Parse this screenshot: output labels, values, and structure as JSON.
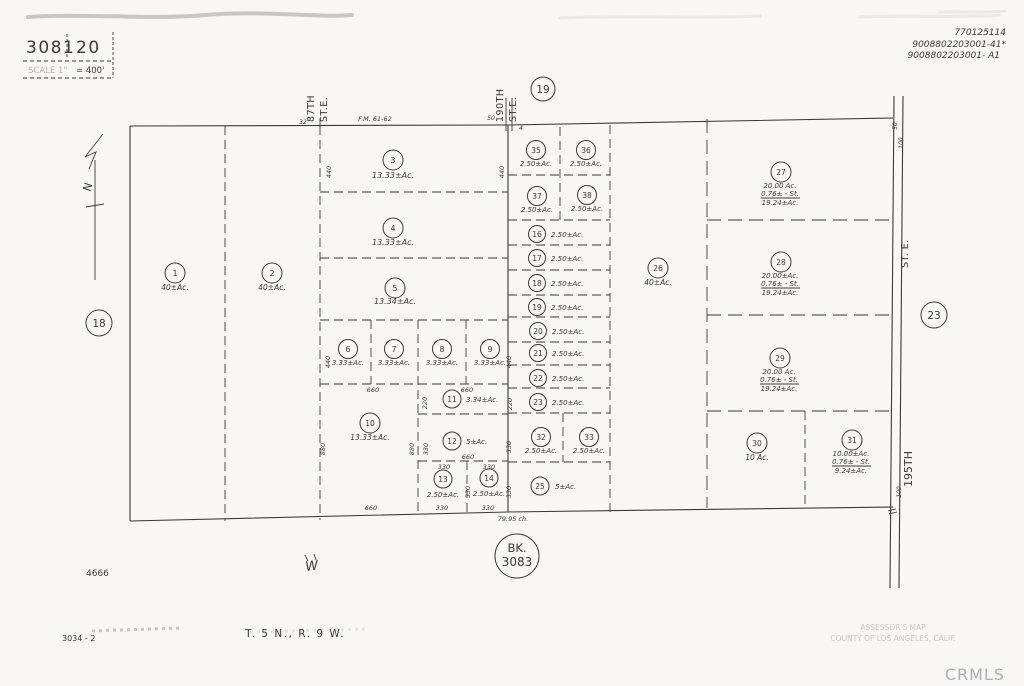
{
  "header": {
    "book": "3081",
    "page": "20",
    "scale_label": "SCALE 1\"",
    "scale_value": "= 400'",
    "handwriting1": "770125114",
    "handwriting2": "9008802203001-41*",
    "handwriting3": "9008802203001- A1"
  },
  "streets": {
    "s87_name": "87TH",
    "s87_suffix": "ST.E.",
    "s190_name": "190TH",
    "s190_suffix": "ST.E.",
    "s195_suffix": "ST. E.",
    "s195_name": "195TH"
  },
  "compass": {
    "north": "N"
  },
  "adjacent_pages": {
    "west": "18",
    "north": "19",
    "east": "23"
  },
  "bk_circle": {
    "prefix": "BK.",
    "number": "3083"
  },
  "survey": {
    "fm_ref": "F.M. 61-62",
    "tick_32": "32",
    "tick_50": "50",
    "tick_4": "4",
    "chains": "79.95 ch.",
    "d440": "440",
    "d660": "660",
    "d330": "330",
    "d880": "880",
    "d220": "220",
    "d100": "100",
    "d50": "50"
  },
  "parcels": {
    "1": {
      "num": "1",
      "area": "40±Ac."
    },
    "2": {
      "num": "2",
      "area": "40±Ac."
    },
    "3": {
      "num": "3",
      "area": "13.33±Ac."
    },
    "4": {
      "num": "4",
      "area": "13.33±Ac."
    },
    "5": {
      "num": "5",
      "area": "13.34±Ac."
    },
    "6": {
      "num": "6",
      "area": "3.33±Ac."
    },
    "7": {
      "num": "7",
      "area": "3.33±Ac."
    },
    "8": {
      "num": "8",
      "area": "3.33±Ac."
    },
    "9": {
      "num": "9",
      "area": "3.33±Ac."
    },
    "10": {
      "num": "10",
      "area": "13.33±Ac."
    },
    "11": {
      "num": "11",
      "area": "3.34±Ac."
    },
    "12": {
      "num": "12",
      "area": "5±Ac."
    },
    "13": {
      "num": "13",
      "area": "2.50±Ac."
    },
    "14": {
      "num": "14",
      "area": "2.50±Ac."
    },
    "16": {
      "num": "16",
      "area": "2.50±Ac."
    },
    "17": {
      "num": "17",
      "area": "2.50±Ac."
    },
    "18": {
      "num": "18",
      "area": "2.50±Ac."
    },
    "19": {
      "num": "19",
      "area": "2.50±Ac."
    },
    "20": {
      "num": "20",
      "area": "2.50±Ac."
    },
    "21": {
      "num": "21",
      "area": "2.50±Ac."
    },
    "22": {
      "num": "22",
      "area": "2.50±Ac."
    },
    "23": {
      "num": "23",
      "area": "2.50±Ac."
    },
    "25": {
      "num": "25",
      "area": "5±Ac."
    },
    "26": {
      "num": "26",
      "area": "40±Ac."
    },
    "27": {
      "num": "27",
      "gross": "20.00 Ac.",
      "street": "0.76± - St.",
      "net": "19.24±Ac."
    },
    "28": {
      "num": "28",
      "gross": "20.00±Ac.",
      "street": "0.76± - St.",
      "net": "19.24±Ac."
    },
    "29": {
      "num": "29",
      "gross": "20.00 Ac.",
      "street": "0.76± - St.",
      "net": "19.24±Ac."
    },
    "30": {
      "num": "30",
      "area": "10 Ac."
    },
    "31": {
      "num": "31",
      "gross": "10.00±Ac.",
      "street": "0.76± - St.",
      "net": "9.24±Ac."
    },
    "32": {
      "num": "32",
      "area": "2.50±Ac."
    },
    "33": {
      "num": "33",
      "area": "2.50±Ac."
    },
    "35": {
      "num": "35",
      "area": "2.50±Ac."
    },
    "36": {
      "num": "36",
      "area": "2.50±Ac."
    },
    "37": {
      "num": "37",
      "area": "2.50±Ac."
    },
    "38": {
      "num": "38",
      "area": "2.50±Ac."
    }
  },
  "footer": {
    "ref_number": "4666",
    "scribble": "W",
    "sheet_ref": "3034 - 2",
    "township": "T. 5 N., R. 9 W.",
    "assessor_line1": "ASSESSOR'S MAP",
    "assessor_line2": "COUNTY OF LOS ANGELES, CALIF.",
    "watermark": "CRMLS"
  }
}
